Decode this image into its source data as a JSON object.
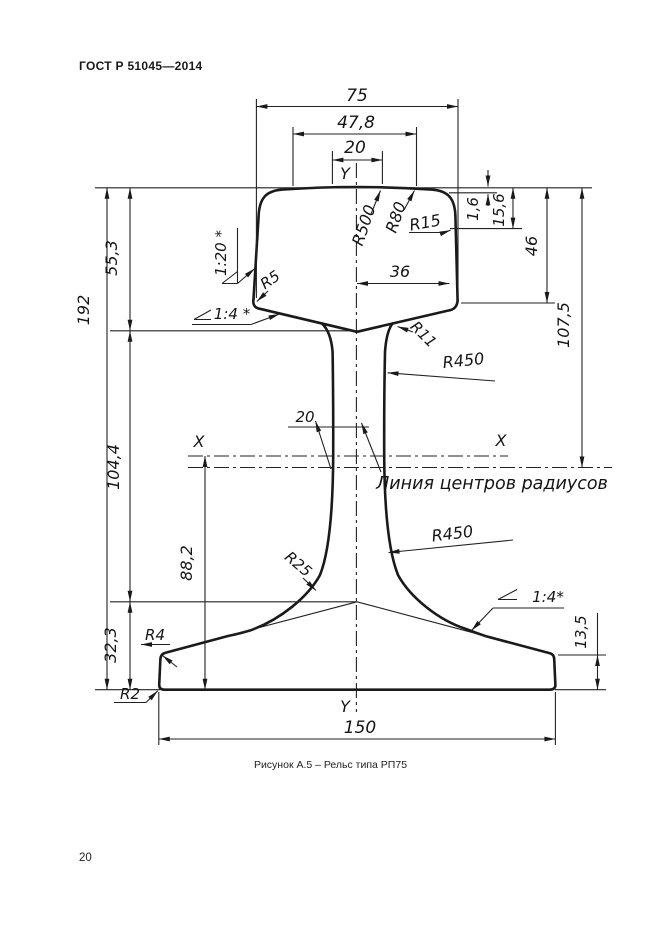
{
  "page": {
    "header": "ГОСТ Р 51045—2014",
    "number": "20",
    "caption": "Рисунок А.5 – Рельс типа РП75"
  },
  "labels": {
    "d75": "75",
    "d47_8": "47,8",
    "d20_top": "20",
    "d36": "36",
    "d20_web": "20",
    "d150": "150",
    "d1_6": "1,6",
    "d15_6": "15,6",
    "d46": "46",
    "d107_5": "107,5",
    "d55_3": "55,3",
    "d192": "192",
    "d104_4": "104,4",
    "d88_2": "88,2",
    "d32_3": "32,3",
    "d13_5": "13,5",
    "r500": "R500",
    "r80": "R80",
    "r15": "R15",
    "r5": "R5",
    "r11": "R11",
    "r450_web": "R450",
    "r450_foot": "R450",
    "r25": "R25",
    "r4": "R4",
    "r2": "R2",
    "slope_1_20": "1:20 *",
    "slope_1_4_left": "1:4 *",
    "slope_1_4_right": "1:4*",
    "axis_x_left": "X",
    "axis_x_right": "X",
    "axis_y_top": "Y",
    "axis_y_bottom": "Y",
    "note_centers": "Линия центров радиусов"
  }
}
